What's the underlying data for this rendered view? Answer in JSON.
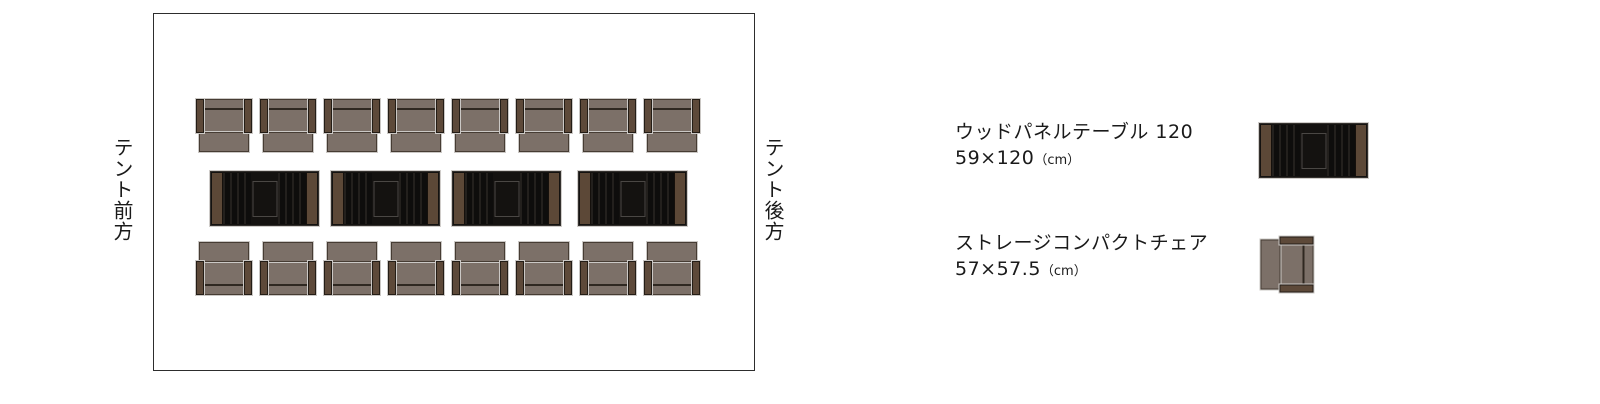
{
  "diagram": {
    "area_label_front": "テント前方",
    "area_label_rear": "テント後方",
    "layout": {
      "top_chair_count": 8,
      "table_count": 4,
      "bottom_chair_count": 8
    }
  },
  "legend": {
    "items": [
      {
        "id": "wood-panel-table",
        "name": "ウッドパネルテーブル 120",
        "dimensions": "59×120",
        "unit": "（cm）"
      },
      {
        "id": "storage-compact-chair",
        "name": "ストレージコンパクトチェア",
        "dimensions": "57×57.5",
        "unit": "（cm）"
      }
    ]
  },
  "colors": {
    "chair_seat": "#7c7068",
    "chair_armrest": "#5d4939",
    "table_surface": "#141210",
    "table_side_panel": "#5c4837",
    "outline": "#2d2d2d",
    "text": "#1a1a1a"
  }
}
